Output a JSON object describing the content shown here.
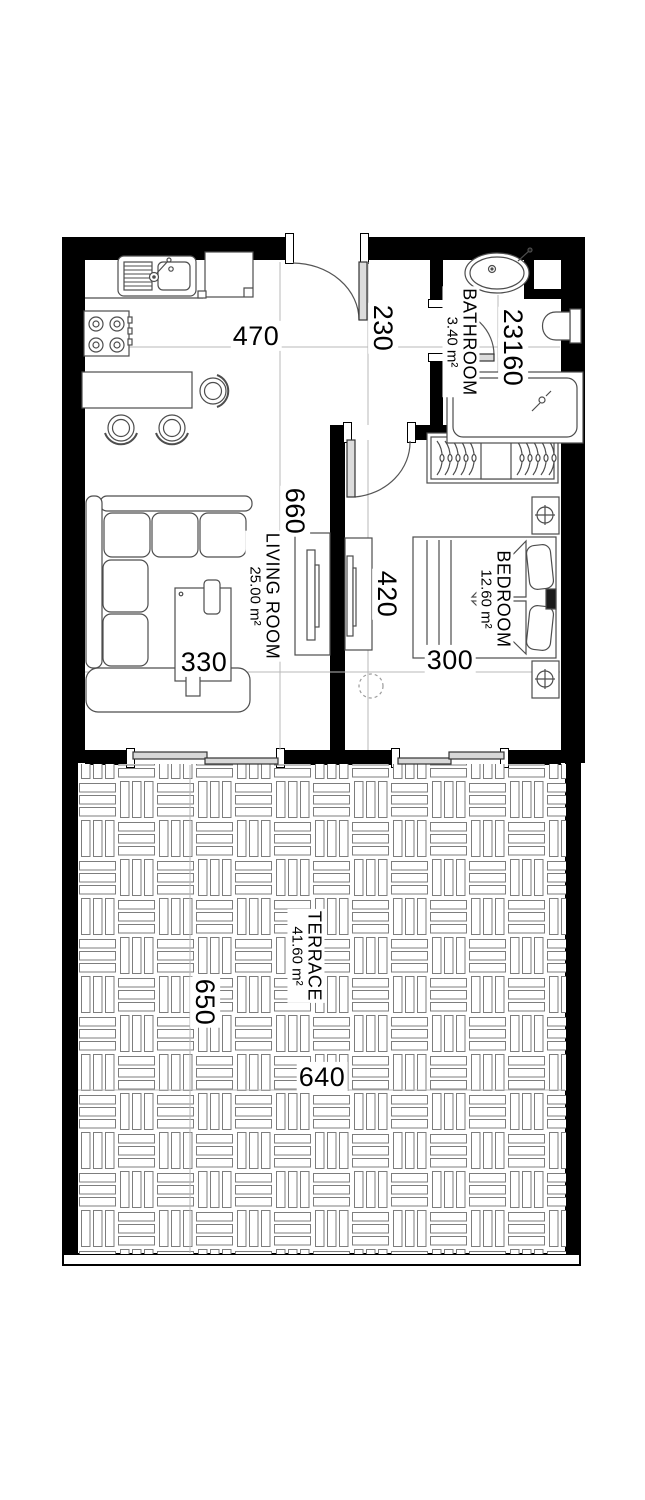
{
  "plan": {
    "rooms": {
      "living_room": {
        "name": "LIVING ROOM",
        "area": "25.00 m²"
      },
      "bedroom": {
        "name": "BEDROOM",
        "area": "12.60 m²"
      },
      "bathroom": {
        "name": "BATHROOM",
        "area": "3.40 m²"
      },
      "terrace": {
        "name": "TERRACE",
        "area": "41.60 m²"
      }
    },
    "dimensions_cm": {
      "living_width": "470",
      "hall_width": "230",
      "bath_width": "230",
      "bath_entry": "160",
      "living_length": "660",
      "coffee_table": "330",
      "bedroom_length": "420",
      "bedroom_width": "300",
      "terrace_length": "650",
      "terrace_width": "640"
    },
    "colors": {
      "wall": "#000000",
      "guide_line": "#b8b8b8",
      "furniture_line": "#4d4d4d"
    }
  }
}
